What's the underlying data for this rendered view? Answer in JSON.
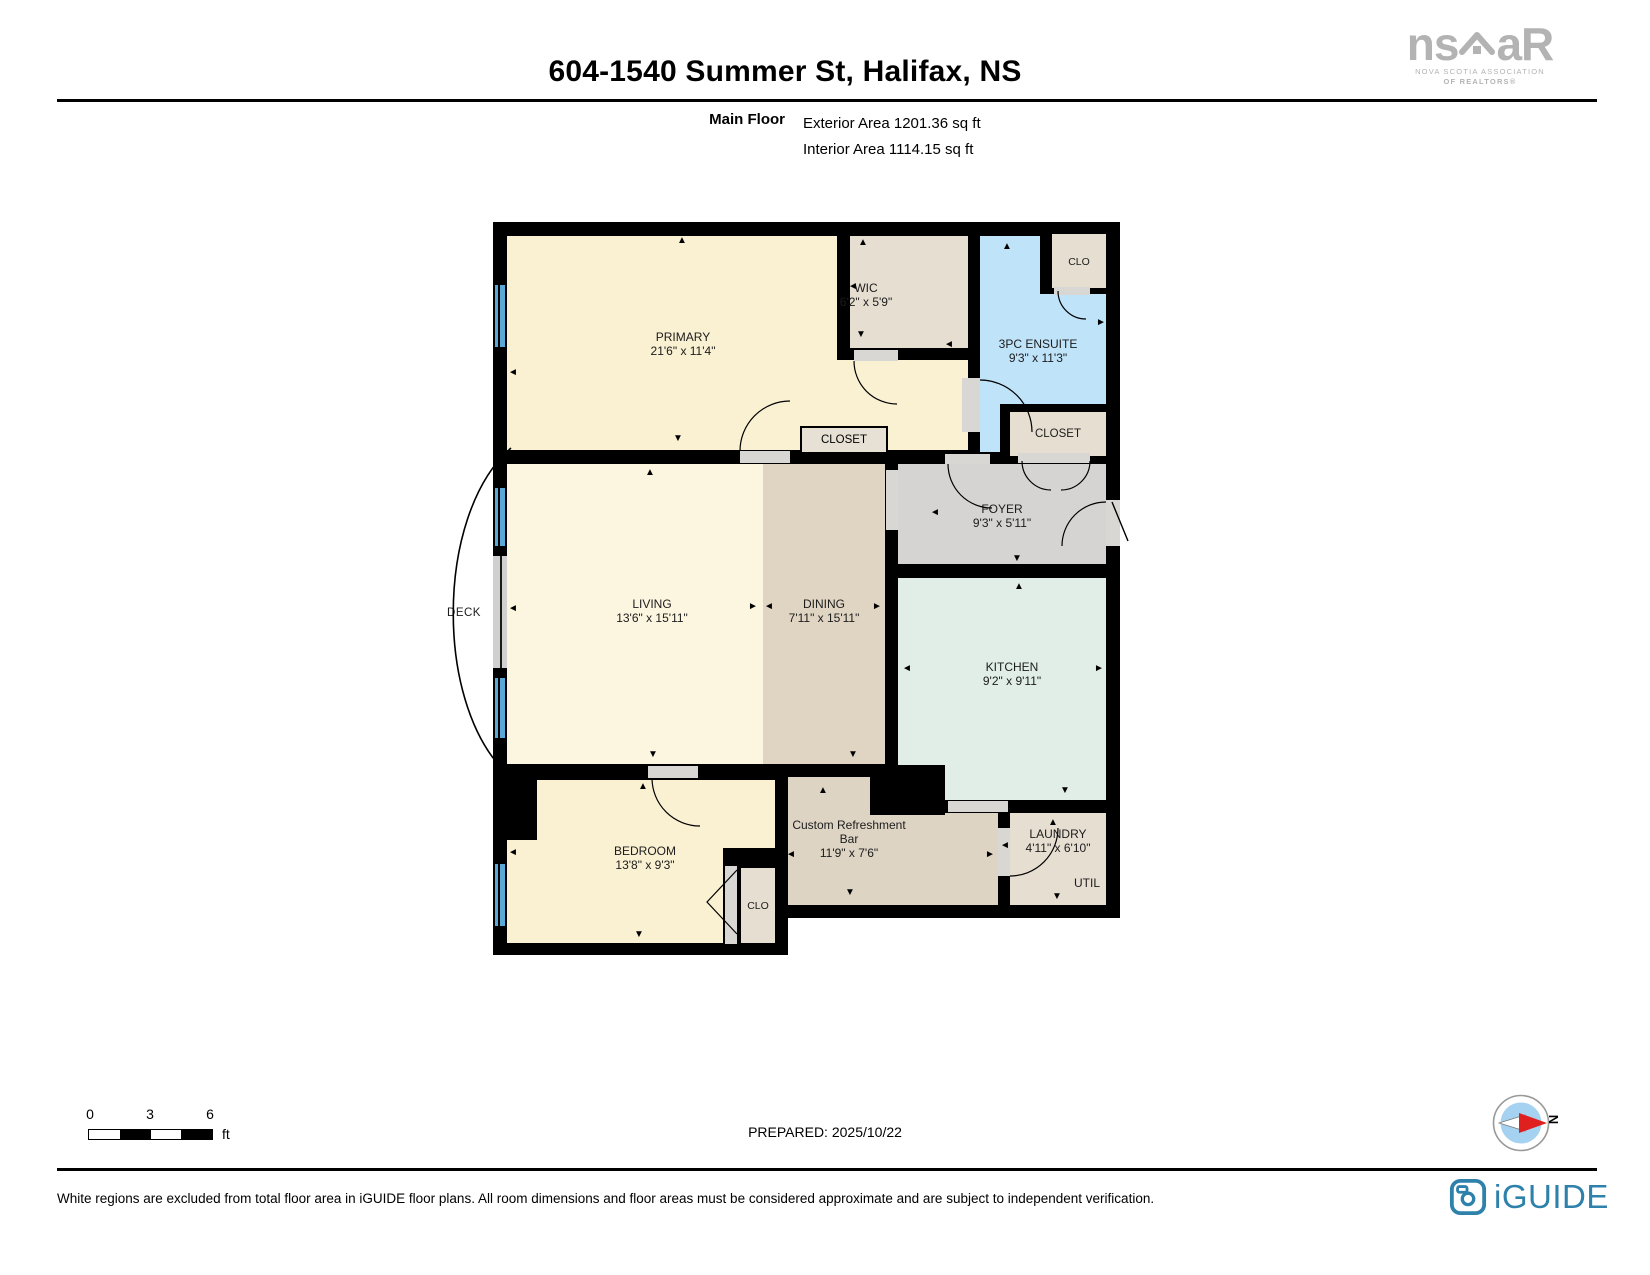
{
  "header": {
    "title": "604-1540 Summer St, Halifax, NS",
    "floor_label": "Main Floor",
    "exterior_area": "Exterior Area 1201.36 sq ft",
    "interior_area": "Interior Area 1114.15 sq ft"
  },
  "nsar_logo": {
    "part1": "ns",
    "part2": "aR",
    "line1": "NOVA SCOTIA ASSOCIATION",
    "line2": "OF REALTORS®"
  },
  "rooms": {
    "primary": {
      "name": "PRIMARY",
      "dims": "21'6\" x 11'4\""
    },
    "wic": {
      "name": "WIC",
      "dims": "6'2\" x 5'9\""
    },
    "ensuite": {
      "name": "3PC ENSUITE",
      "dims": "9'3\" x 11'3\""
    },
    "clo_top": {
      "name": "CLO"
    },
    "closet_primary": {
      "name": "CLOSET"
    },
    "closet_foyer": {
      "name": "CLOSET"
    },
    "foyer": {
      "name": "FOYER",
      "dims": "9'3\" x 5'11\""
    },
    "living": {
      "name": "LIVING",
      "dims": "13'6\" x 15'11\""
    },
    "dining": {
      "name": "DINING",
      "dims": "7'11\" x 15'11\""
    },
    "kitchen": {
      "name": "KITCHEN",
      "dims": "9'2\" x 9'11\""
    },
    "deck": {
      "name": "DECK"
    },
    "bedroom": {
      "name": "BEDROOM",
      "dims": "13'8\" x 9'3\""
    },
    "clo_bedroom": {
      "name": "CLO"
    },
    "bar": {
      "name": "Custom Refreshment Bar",
      "dims": "11'9\" x 7'6\""
    },
    "laundry": {
      "name": "LAUNDRY",
      "dims": "4'11\" x 6'10\""
    },
    "util": {
      "name": "UTIL"
    }
  },
  "icons": {
    "up": "▲",
    "down": "▼",
    "left": "◄",
    "right": "►"
  },
  "scale_bar": {
    "tick0": "0",
    "tick1": "3",
    "tick2": "6",
    "unit": "ft"
  },
  "footer": {
    "prepared": "PREPARED: 2025/10/22",
    "disclaimer": "White regions are excluded from total floor area in iGUIDE floor plans. All room dimensions and floor areas must be considered approximate and are subject to independent verification.",
    "compass_north": "N",
    "iguide_label": "iGUIDE"
  },
  "colors": {
    "wall": "#000000",
    "room_cream": "#faf0d2",
    "room_pale": "#fcf5e0",
    "room_beige": "#e6ded1",
    "room_blue": "#bfe3f8",
    "room_gray": "#d5d4d2",
    "room_mint": "#e1eee7",
    "room_tan": "#e0d5c2",
    "room_bar": "#ded4c4",
    "window_blue": "#58a8d8",
    "iguide_teal": "#2e81ab",
    "nsar_gray": "#b3b3b3",
    "compass_red": "#e01f1f"
  }
}
